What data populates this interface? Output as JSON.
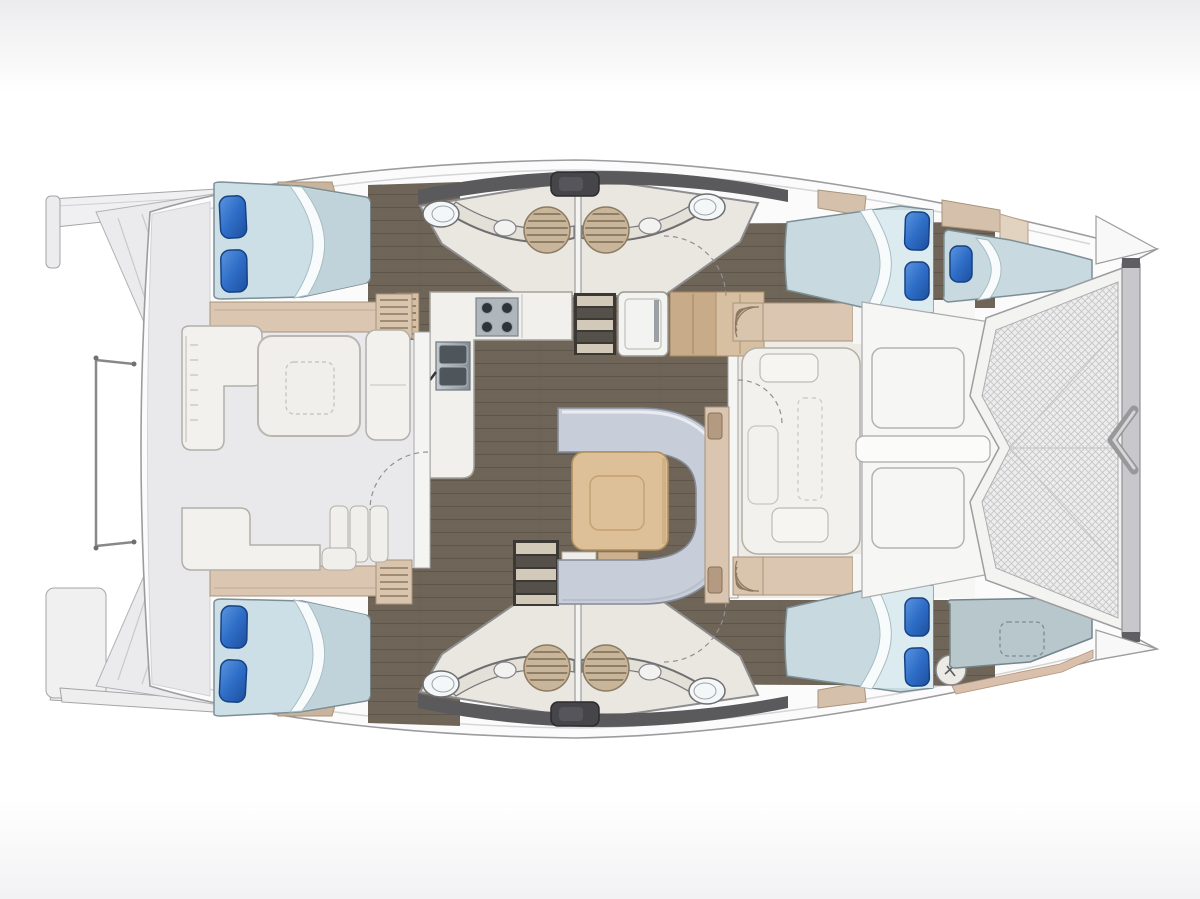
{
  "diagram": {
    "kind": "catamaran-yacht-floor-plan",
    "orientation": "bow-right-stern-left",
    "hulls": 2,
    "cabins": 4,
    "double_berths": 4,
    "bow_single_berths": 1,
    "bow_cushion_pads": 1,
    "bathrooms": 4,
    "toilets": 4,
    "sinks": 4,
    "shower_mats": 4,
    "salon": {
      "sofa": "u-shaped",
      "table": "square-wood",
      "galley": "l-shaped",
      "stove_burners": 4,
      "sink_basins": 2,
      "fridge": 1
    },
    "cockpits": {
      "aft": [
        "l-sofa",
        "table",
        "bench",
        "steps"
      ],
      "forward": [
        "lounge-seat"
      ]
    },
    "deck": {
      "trampoline": 1,
      "foredeck_hatches": 2,
      "crossbeam": 1,
      "bowsprit_bracket": 1,
      "windlass": 1,
      "stern_platforms": 2,
      "railing_posts": 2
    }
  },
  "palette": {
    "background": "#ffffff",
    "background_band": "#ededef",
    "hull_white": "#fbfbfc",
    "hull_outline": "#9c9c9e",
    "deck_gray": "#e9e9eb",
    "floor_brown": "#6e6457",
    "floor_plank_line": "#5e564b",
    "bathroom_cream": "#eae7e0",
    "coachroof_dark": "#5a5a5d",
    "hatch_dark": "#46464a",
    "tan_furniture": "#dac6b1",
    "wood_cabinet": "#c8ab89",
    "wood_table": "#ddbf98",
    "mattress_blue": "#cddfe6",
    "mattress_shade": "#c0d3da",
    "sheet_white": "#f7fbfc",
    "pillow_blue_light": "#5a95e0",
    "pillow_blue_dark": "#1d4f9e",
    "sofa_gray": "#c7ced9",
    "seat_white": "#f2f1ed",
    "mat_tan": "#c9b69a",
    "steel": "#9aa2a9",
    "trampoline_mesh": "#c6c6c8",
    "sunpad_gray": "#b7c7cc"
  }
}
